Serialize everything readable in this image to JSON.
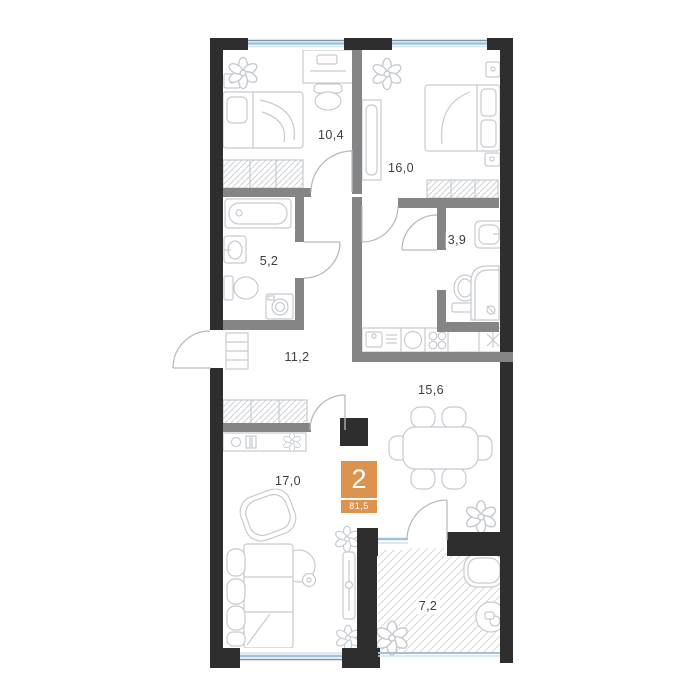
{
  "plan": {
    "badge": {
      "rooms": "2",
      "total_area": "81,5"
    },
    "rooms": [
      {
        "id": "bedroom-1",
        "area": "10,4"
      },
      {
        "id": "bedroom-2",
        "area": "16,0"
      },
      {
        "id": "bathroom-small",
        "area": "3,9"
      },
      {
        "id": "bathroom",
        "area": "5,2"
      },
      {
        "id": "hallway",
        "area": "11,2"
      },
      {
        "id": "kitchen-living",
        "area": "15,6"
      },
      {
        "id": "living-room",
        "area": "17,0"
      },
      {
        "id": "balcony",
        "area": "7,2"
      }
    ],
    "colors": {
      "outer_wall": "#2e2e2e",
      "inner_wall": "#858585",
      "furniture_line": "#c6cad0",
      "door_line": "#b6bbc1",
      "window_blue": "#9dc3da",
      "window_light": "#cfe2ee",
      "hatch": "#d6d8db",
      "accent_orange": "#dc9350",
      "label_text": "#3d3d3d"
    }
  }
}
